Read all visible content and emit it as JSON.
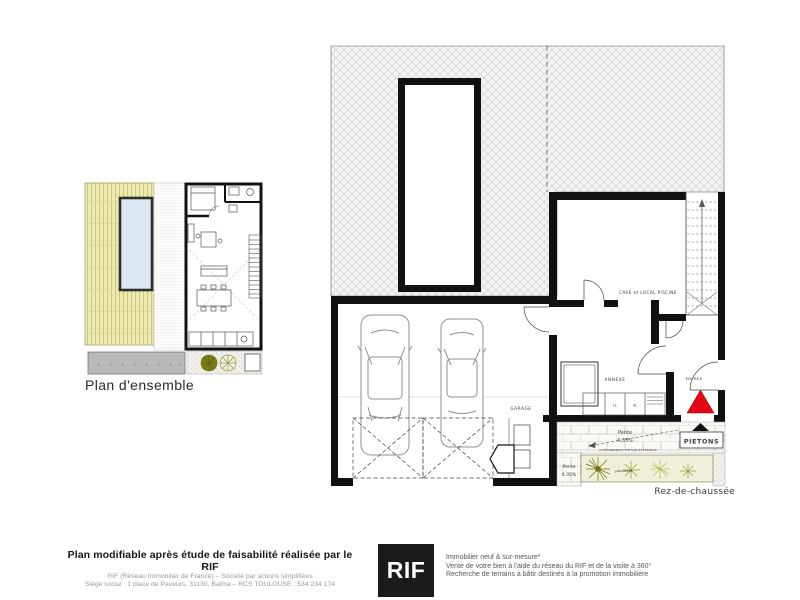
{
  "small_plan": {
    "caption": "Plan d'ensemble"
  },
  "main_plan": {
    "caption": "Rez-de-chaussée",
    "rooms": {
      "cave": "CAVE et LOCAL PISCINE",
      "garage": "GARAGE",
      "annexe": "ANNEXE",
      "entree": "ENTREE",
      "ll": "LL",
      "sl": "SL"
    },
    "site": {
      "pietons": "PIETONS",
      "pente_label": "Pente",
      "pente_value": "4.35%",
      "pente2_label": "Pente",
      "pente2_value": "4.35%",
      "cheminement": "CHEMINEMENT PIETON EXTERIEUR",
      "jardiniere": "JARDINIERE"
    }
  },
  "footer": {
    "left": {
      "title": "Plan modifiable après étude de faisabilité réalisée par le RIF",
      "line1": "RIF (Réseau Immobilier de France) – Société par actions simplifiées",
      "line2": "Siège social : 1 place de Paveurs, 31130, Balma – RCS TOULOUSE : 534 234 174"
    },
    "logo": "RIF",
    "right": {
      "line1": "Immobilier neuf & sur-mesure*",
      "line2": "Vente de votre bien à l'aide du réseau du RIF et de la visite à 360°",
      "line3": "Recherche de terrains à bâtir destinés à la promotion immobilière"
    }
  },
  "colors": {
    "entry_marker": "#e30613",
    "pietons_marker": "#111111",
    "pool": "#dce9f5",
    "garden": "#eceab0",
    "olive": "#7d7d14",
    "driveway": "#b9b9b9",
    "wall": "#111111",
    "hatch_line": "#cccccc"
  }
}
